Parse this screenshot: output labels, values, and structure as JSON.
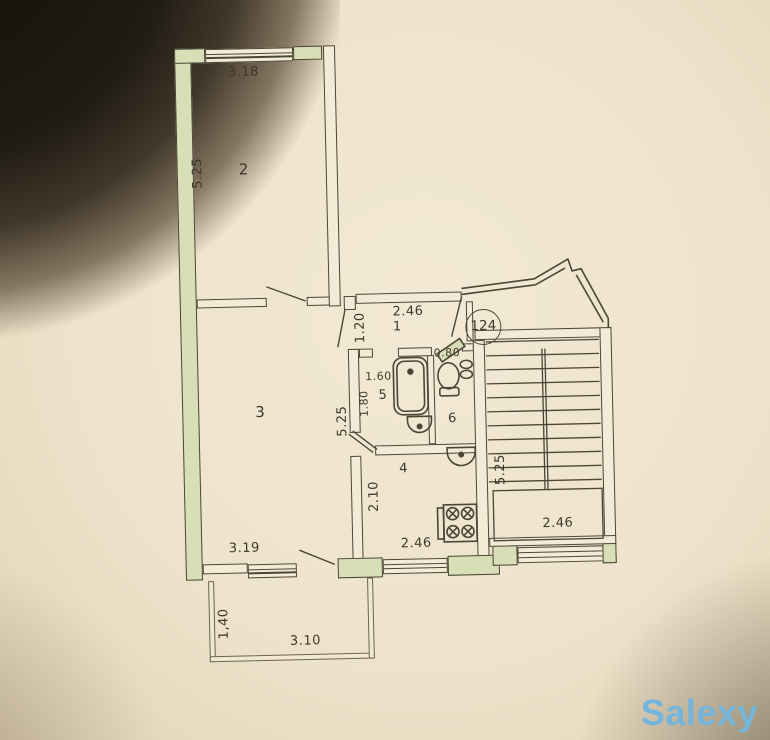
{
  "photo": {
    "watermark": "Salexy"
  },
  "apartment": {
    "number": "124"
  },
  "rooms": {
    "hall": {
      "label": "1",
      "dims": {
        "width": "2.46",
        "depth": "1.20"
      }
    },
    "room2": {
      "label": "2",
      "dims": {
        "width": "3.18",
        "depth": "5.25"
      }
    },
    "room3": {
      "label": "3",
      "dims": {
        "width": "3.19",
        "depth": "5.25"
      }
    },
    "kitchen": {
      "label": "4",
      "dims": {
        "width": "2.46",
        "depth": "2.10"
      }
    },
    "bathroom": {
      "label": "5",
      "dims": {
        "width": "1.60",
        "depth": "1.80"
      }
    },
    "wc": {
      "label": "6",
      "dims": {
        "width": "0.80"
      }
    },
    "stairwell": {
      "dims": {
        "depth": "5.25",
        "width": "2.46"
      }
    },
    "balcony": {
      "dims": {
        "depth": "1,40",
        "width": "3.10"
      }
    }
  },
  "fixtures": [
    "bathtub",
    "bathroom-sink",
    "toilet",
    "kitchen-sink",
    "stove",
    "staircase"
  ],
  "colors": {
    "paper": "#f1e8d3",
    "wall_fill": "#d8deb6",
    "line": "#4c4637",
    "watermark": "#74b5dc"
  }
}
